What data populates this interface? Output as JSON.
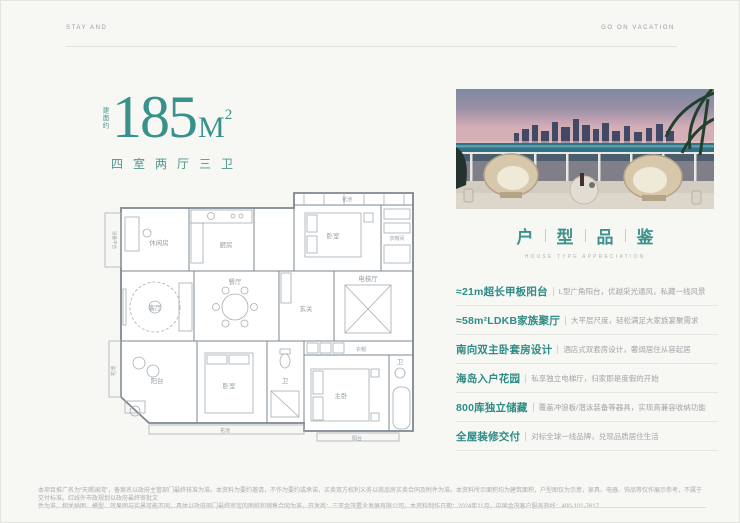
{
  "colors": {
    "accent": "#2f8c86",
    "headline_teal": "#38918b",
    "plan_line": "#8a929c"
  },
  "header": {
    "left": "STAY AND",
    "right": "GO ON VACATION"
  },
  "headline": {
    "prefix_vertical": "建面约",
    "area_number": "185",
    "area_unit": "M",
    "area_sup": "2",
    "layout_text": "四室两厅三卫"
  },
  "floorplan": {
    "labels": {
      "flower_top": "花池",
      "bedroom2": "卧室",
      "closet": "衣帽间",
      "kitchen": "厨房",
      "leisure": "休闲房",
      "equipment": "设备平台",
      "living": "客厅",
      "dining": "餐厅",
      "foyer": "玄关",
      "elevator": "电梯厅",
      "balcony": "阳台",
      "bedroom3": "卧室",
      "bath2": "卫",
      "wardrobe": "衣帽",
      "master": "主卧",
      "master_bath": "卫",
      "flower_left": "花池",
      "flower_bottom": "花池",
      "balcony_bottom": "阳台"
    }
  },
  "appreciation": {
    "title_chars": [
      "户",
      "型",
      "品",
      "鉴"
    ],
    "subtitle": "HOUSE TYPE APPRECIATION"
  },
  "features": [
    {
      "heading": "≈21m超长甲板阳台",
      "desc": "L型广角阳台，优越采光通风，私藏一线风景"
    },
    {
      "heading": "≈58m²LDKB家族聚厅",
      "desc": "大平层尺度，轻松满足大家族宴聚需求"
    },
    {
      "heading": "南向双主卧套房设计",
      "desc": "酒店式双套房设计，奢阔居住从容起居"
    },
    {
      "heading": "海岛入户花园",
      "desc": "私享独立电梯厅，归家即是度假的开始"
    },
    {
      "heading": "800库独立储藏",
      "desc": "覆盖冲浪板/潜泳装备等器具，实现高兼容收纳功能"
    },
    {
      "heading": "全屋装修交付",
      "desc": "对标全球一线品牌，兑现品质居住生活"
    }
  ],
  "footer": {
    "line1": "本项目推广名为“天赐澜湾”，备案名以政府主管部门最终核准为准。本资料为要约邀请，不作为要约或承诺，买卖双方权利义务以商品房买卖合同及附件为准。本资料所示面积均为建筑面积，户型图仅为示意，家具、电器、饰品等仅作展示参考，不属于交付标准。红线外市政规划以政府最终审批文",
    "line2": "件为准。相关插图、模型、效果图与实景可能不同，具体以政府部门最终审定的图纸和销售合同为准。开发商：三亚金茂置业发展有限公司。本资料制作日期：2024年11月。中国金茂客户服务热线：400-101-7617"
  }
}
